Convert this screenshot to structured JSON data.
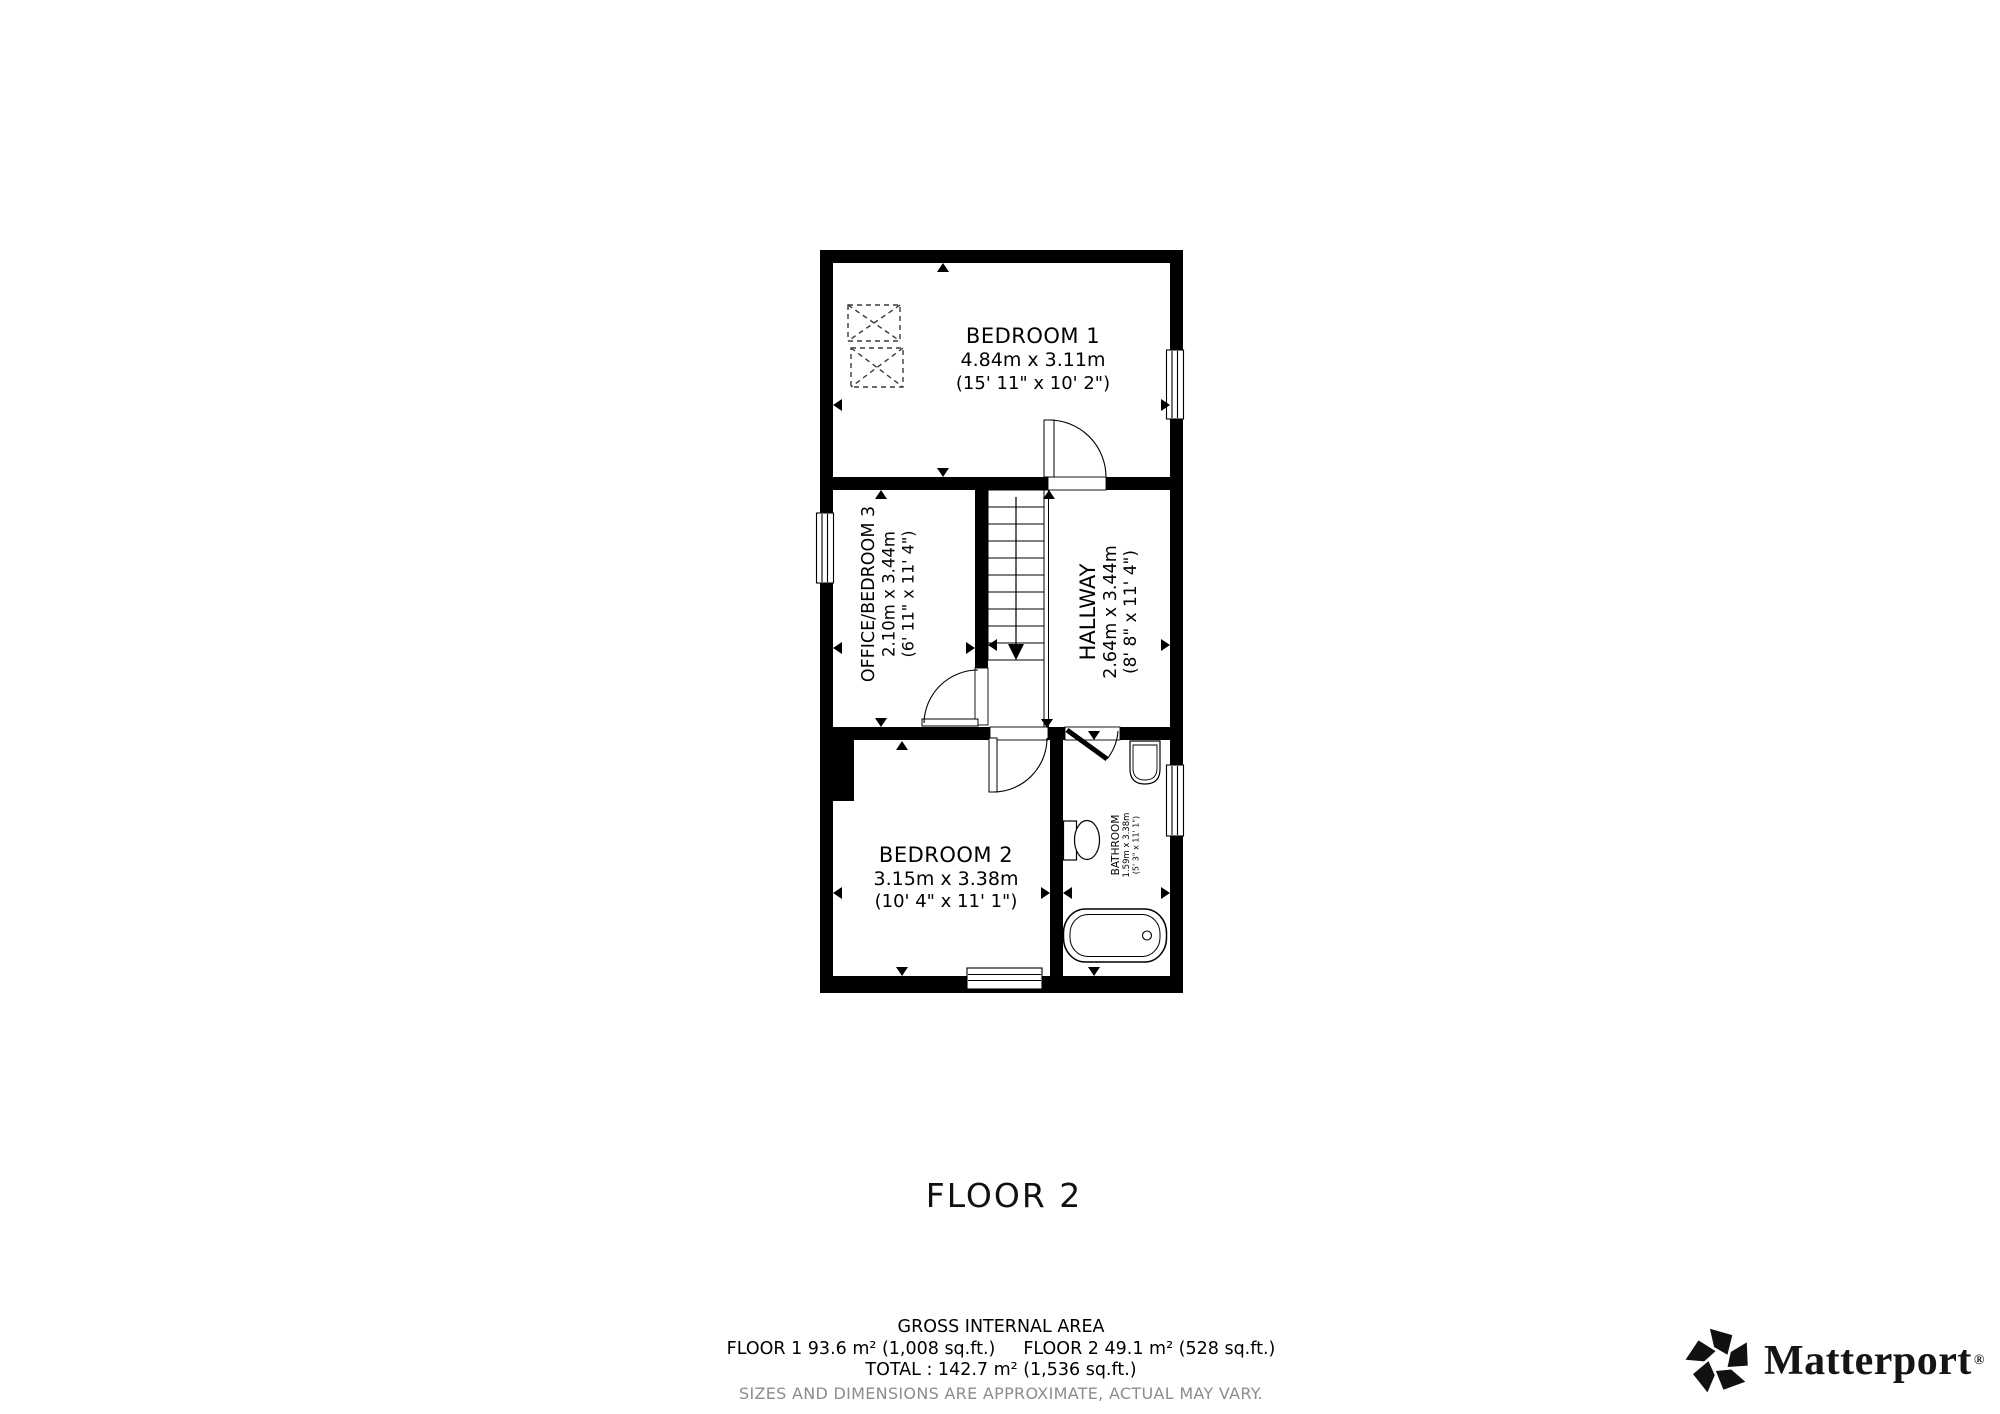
{
  "floor_plan": {
    "rooms": [
      {
        "name": "BEDROOM 1",
        "metric": "4.84m x 3.11m",
        "imperial": "(15' 11\" x 10' 2\")"
      },
      {
        "name": "OFFICE/BEDROOM 3",
        "metric": "2.10m x 3.44m",
        "imperial": "(6' 11\" x 11' 4\")"
      },
      {
        "name": "HALLWAY",
        "metric": "2.64m x 3.44m",
        "imperial": "(8' 8\" x 11' 4\")"
      },
      {
        "name": "BEDROOM 2",
        "metric": "3.15m x 3.38m",
        "imperial": "(10' 4\" x 11' 1\")"
      },
      {
        "name": "BATHROOM",
        "metric": "1.59m x 3.38m",
        "imperial": "(5' 3\" x 11' 1\")"
      }
    ],
    "stairs_direction_icon": "down-arrow",
    "fixture_icons": [
      "bathtub",
      "toilet",
      "sink",
      "skylight",
      "window",
      "door-swing"
    ]
  },
  "floor_title": "FLOOR 2",
  "area_summary": {
    "heading": "GROSS INTERNAL AREA",
    "floor1": "FLOOR 1 93.6 m² (1,008 sq.ft.)",
    "floor2": "FLOOR 2 49.1 m² (528 sq.ft.)",
    "total": "TOTAL :  142.7 m² (1,536 sq.ft.)",
    "disclaimer": "SIZES AND DIMENSIONS ARE APPROXIMATE, ACTUAL MAY VARY."
  },
  "brand": {
    "wordmark": "Matterport",
    "registered_mark": "®"
  },
  "colors": {
    "wall": "#000000",
    "floor": "#ffffff",
    "disclaimer_gray": "#8c8c8c"
  }
}
